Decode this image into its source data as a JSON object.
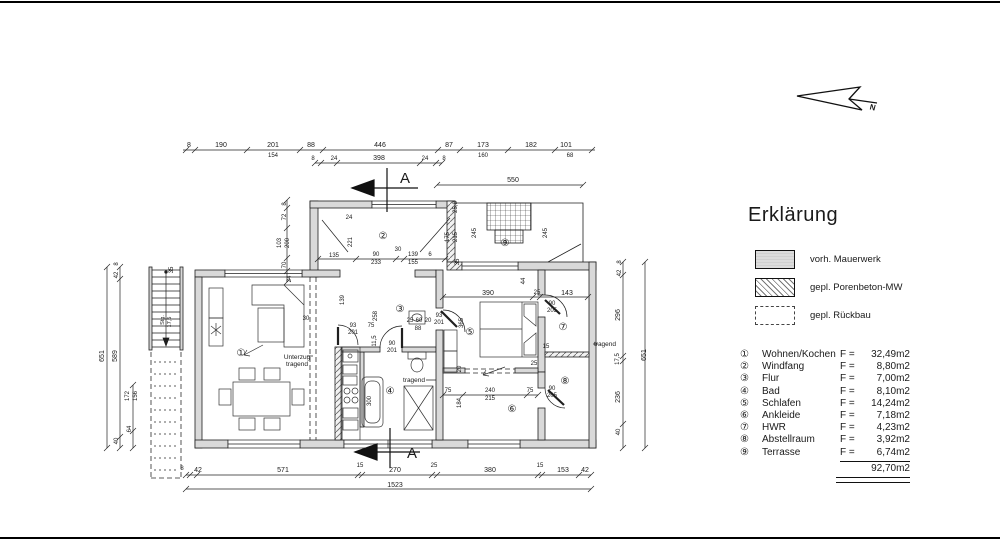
{
  "legend": {
    "title": "Erklärung",
    "items": [
      {
        "label": "vorh. Mauerwerk"
      },
      {
        "label": "gepl. Porenbeton-MW"
      },
      {
        "label": "gepl. Rückbau"
      }
    ]
  },
  "rooms": [
    {
      "num": "①",
      "name": "Wohnen/Kochen",
      "prefix": "F =",
      "area": "32,49m2"
    },
    {
      "num": "②",
      "name": "Windfang",
      "prefix": "F =",
      "area": "8,80m2"
    },
    {
      "num": "③",
      "name": "Flur",
      "prefix": "F =",
      "area": "7,00m2"
    },
    {
      "num": "④",
      "name": "Bad",
      "prefix": "F =",
      "area": "8,10m2"
    },
    {
      "num": "⑤",
      "name": "Schlafen",
      "prefix": "F =",
      "area": "14,24m2"
    },
    {
      "num": "⑥",
      "name": "Ankleide",
      "prefix": "F =",
      "area": "7,18m2"
    },
    {
      "num": "⑦",
      "name": "HWR",
      "prefix": "F =",
      "area": "4,23m2"
    },
    {
      "num": "⑧",
      "name": "Abstellraum",
      "prefix": "F =",
      "area": "3,92m2"
    },
    {
      "num": "⑨",
      "name": "Terrasse",
      "prefix": "F =",
      "area": "6,74m2"
    }
  ],
  "total_area": "92,70m2",
  "plan": {
    "markers": [
      "①",
      "②",
      "③",
      "④",
      "⑤",
      "⑥",
      "⑦",
      "⑧",
      "⑨"
    ],
    "section": "A",
    "north": "N",
    "labels": {
      "unterzug1": "Unterzug",
      "unterzug2": "tragend",
      "bath": "tragend",
      "right": "tragend",
      "stairs1": "Stg.",
      "stairs2": "17,5"
    }
  },
  "dims": {
    "t1": [
      "8",
      "190",
      "201",
      "88",
      "446",
      "87",
      "173",
      "182",
      "101"
    ],
    "t1s": [
      "154",
      "160",
      "68"
    ],
    "t2": [
      "8",
      "24",
      "398",
      "24",
      "8"
    ],
    "t3": "550",
    "b1": [
      "8",
      "42",
      "571",
      "15",
      "270",
      "25",
      "380",
      "15",
      "153",
      "42"
    ],
    "b2": "1523",
    "left": [
      "651",
      "42",
      "8",
      "589",
      "40",
      "172",
      "156",
      "64",
      "24",
      "35"
    ],
    "right": [
      "651",
      "42",
      "8",
      "296",
      "17,5",
      "236",
      "40"
    ],
    "inner": [
      "24",
      "221",
      "135",
      "90",
      "233",
      "30",
      "139",
      "155",
      "6",
      "72",
      "8",
      "103",
      "200",
      "70",
      "25,8",
      "175",
      "215",
      "245",
      "245",
      "35",
      "30",
      "139",
      "258",
      "93",
      "201",
      "75",
      "11,5",
      "90",
      "201",
      "25",
      "60",
      "20",
      "88",
      "93",
      "201",
      "300",
      "tragend",
      "44",
      "390",
      "25",
      "143",
      "90",
      "205",
      "365",
      "15",
      "20",
      "25",
      "75",
      "240",
      "215",
      "75",
      "90",
      "205",
      "184"
    ]
  }
}
